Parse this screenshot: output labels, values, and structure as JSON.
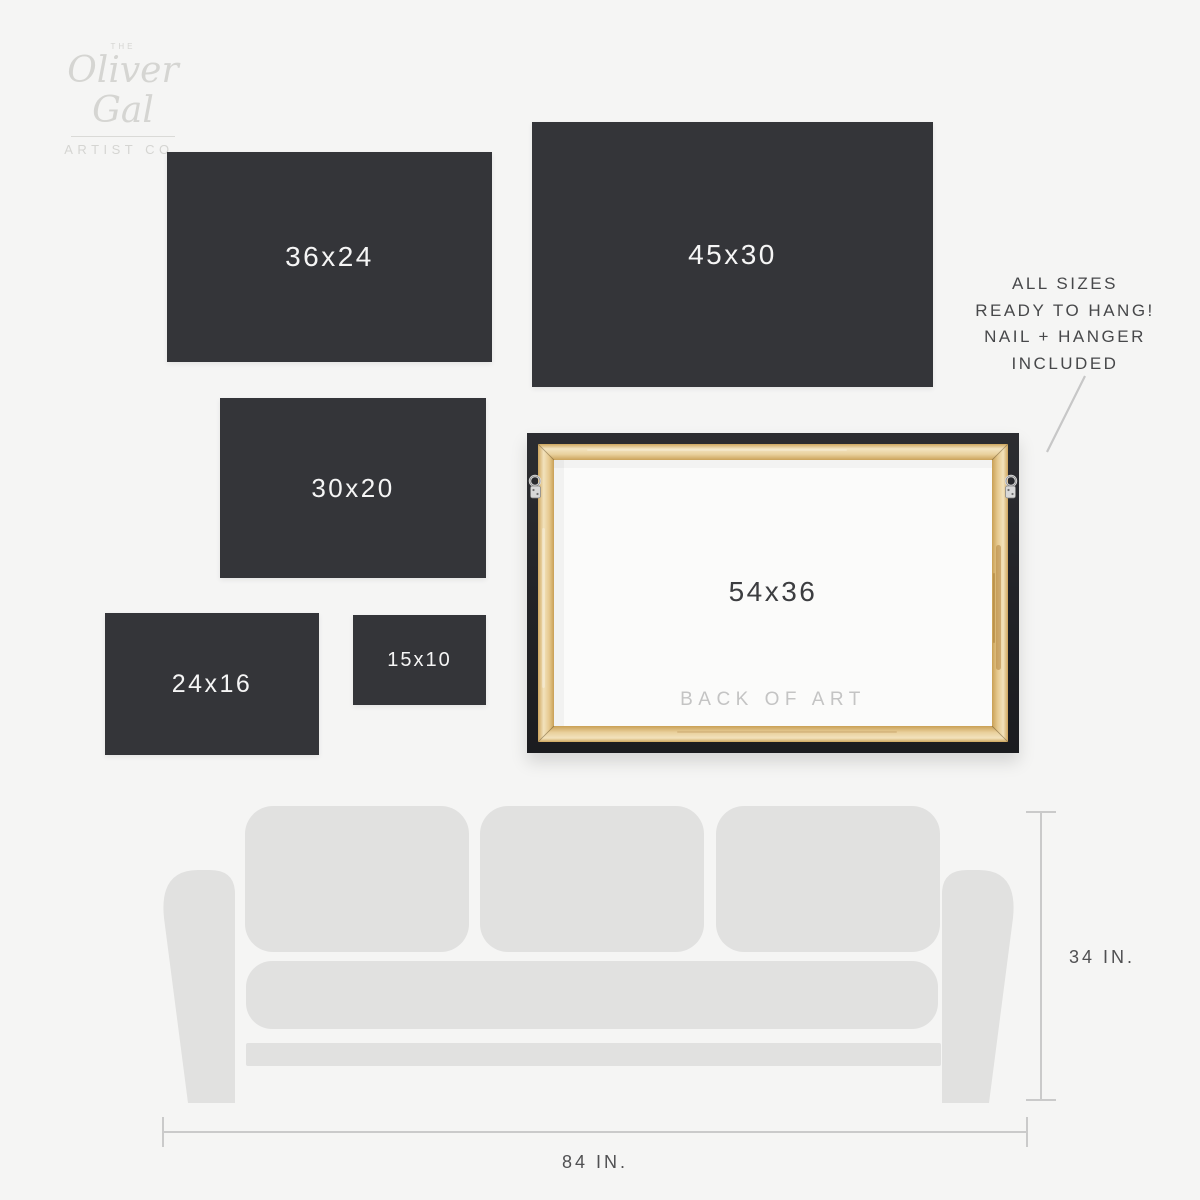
{
  "brand": {
    "the": "THE",
    "name": "Oliver Gal",
    "subtitle": "ARTIST CO."
  },
  "hang_note": {
    "line1": "ALL SIZES",
    "line2": "READY TO HANG!",
    "line3": "NAIL + HANGER",
    "line4": "INCLUDED"
  },
  "sizes": {
    "s36x24": "36x24",
    "s45x30": "45x30",
    "s30x20": "30x20",
    "s24x16": "24x16",
    "s15x10": "15x10"
  },
  "back_of_art": {
    "size": "54x36",
    "caption": "BACK OF ART"
  },
  "sofa": {
    "height": "34 IN.",
    "width": "84 IN."
  },
  "colors": {
    "background": "#f5f5f4",
    "panel_dark": "#343539",
    "panel_text": "#f5f5f5",
    "sofa_gray": "#e1e1e0",
    "wood_light": "#f3e4c0",
    "wood_mid": "#e6c98f",
    "wood_dark": "#c9a055",
    "frame_border": "#232428",
    "measure_line": "#cacaca",
    "measure_text": "#505052",
    "logo_gray": "#d5d5d2",
    "note_text": "#47484a",
    "caption_gray": "#c4c4c4"
  }
}
